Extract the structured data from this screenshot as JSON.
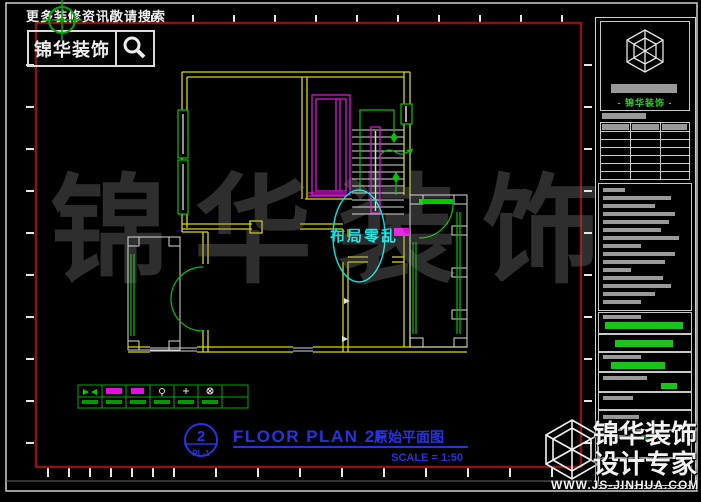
{
  "header": {
    "search_hint": "更多装修资讯敬请搜索",
    "brand": "锦华装饰",
    "search_icon": "magnifier"
  },
  "plan": {
    "annotation": "布局零乱",
    "legend_symbols": [
      "double-arrow",
      "light-strip",
      "light-strip-small",
      "pendant-lamp",
      "ceiling-lamp",
      "wall-lamp"
    ]
  },
  "title_block": {
    "number": "2",
    "sheet_no": "PL-1",
    "title_en": "FLOOR PLAN 2F",
    "title_cn": "原始平面图",
    "scale": "SCALE = 1:50"
  },
  "side_panel": {
    "brand": "- 锦华装饰 -"
  },
  "watermark": {
    "text": "锦华装饰"
  },
  "footer_badge": {
    "brand": "锦华装饰",
    "tagline": "设计专家",
    "website": "WWW.JS-JINHUA.COM"
  },
  "colors": {
    "wall": "#d8d800",
    "window": "#00c800",
    "furniture": "#e010e0",
    "annotation": "#00dede",
    "title": "#2733e0",
    "sheet_border": "#8a1414",
    "watermark": "#2e2e2e"
  }
}
